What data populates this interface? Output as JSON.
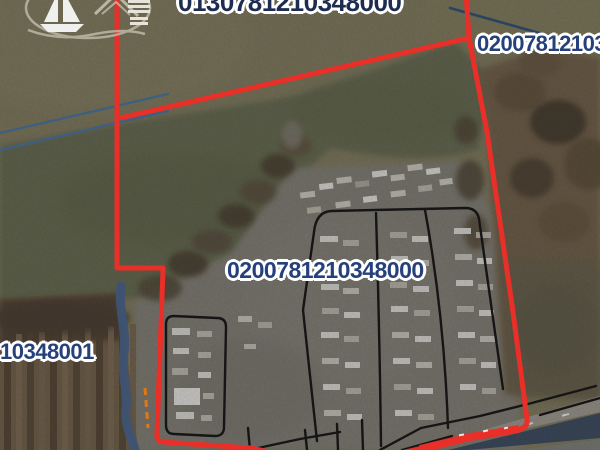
{
  "map_labels": {
    "top_parcel_id": "0130781210348000",
    "right_parcel_id": "0200781210348000",
    "center_parcel_id": "0200781210348000",
    "left_parcel_id": "10348001"
  },
  "colors": {
    "parcel_boundary_red": "#ea2e28",
    "parcel_line_black": "#151515",
    "road_line_blue": "#3f5f80",
    "stream_blue": "#3e5372",
    "label_text_blue": "#26407a",
    "label_text_dark": "#1f2c52",
    "label_halo": "#ffffff",
    "highlight_orange": "#e07818"
  },
  "icons": {
    "watermark": "sailboat-logo"
  }
}
